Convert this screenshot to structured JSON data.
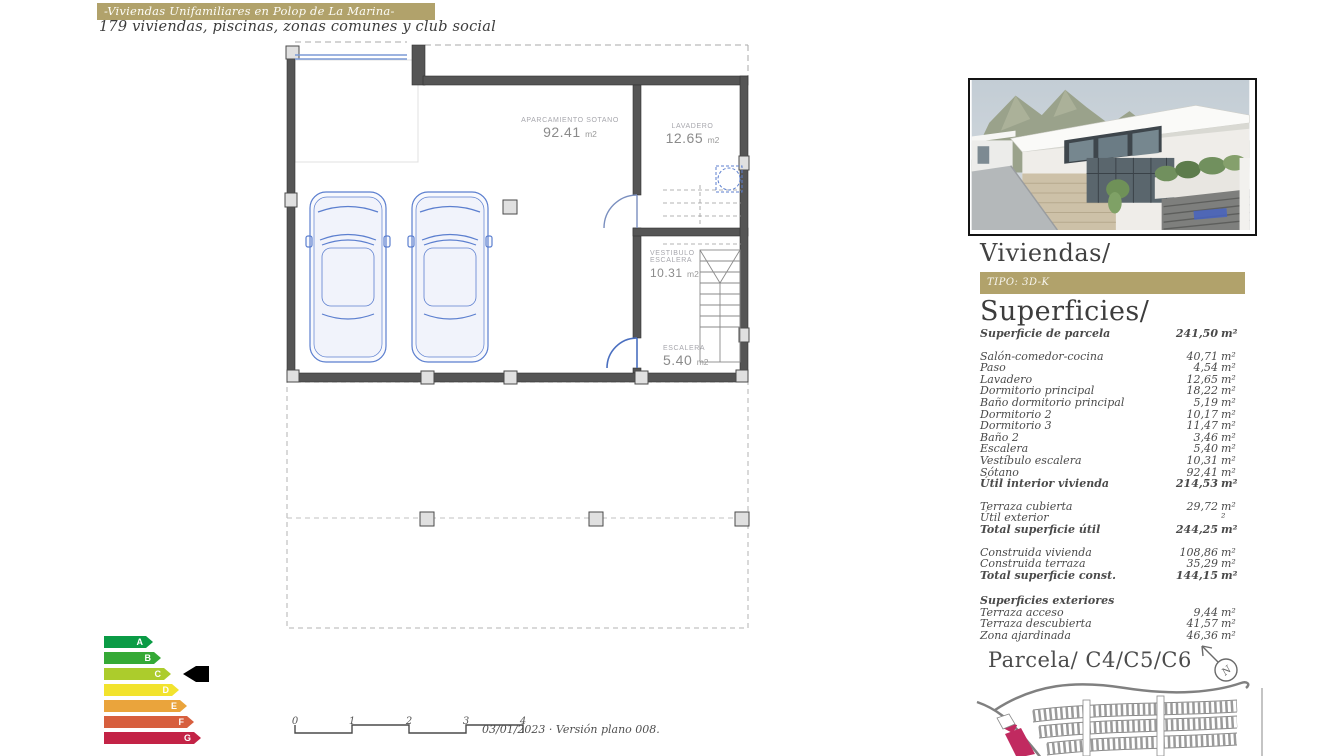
{
  "header": {
    "title": "-Viviendas Unifamiliares en Polop de La Marina-",
    "subtitle": "179 viviendas, piscinas, zonas comunes y club social"
  },
  "plan": {
    "rooms": [
      {
        "name": "APARCAMIENTO SOTANO",
        "value": "92.41",
        "unit": "m2"
      },
      {
        "name": "LAVADERO",
        "value": "12.65",
        "unit": "m2"
      },
      {
        "name": "VESTIBULO ESCALERA",
        "value": "10.31",
        "unit": "m2"
      },
      {
        "name": "ESCALERA",
        "value": "5.40",
        "unit": "m2"
      }
    ]
  },
  "energy": {
    "current": "B",
    "arrow_color": "#000000",
    "grades": [
      {
        "letter": "A",
        "color": "#0a9b45",
        "width": 42
      },
      {
        "letter": "B",
        "color": "#35a936",
        "width": 50
      },
      {
        "letter": "C",
        "color": "#accc2c",
        "width": 60
      },
      {
        "letter": "D",
        "color": "#f2e32e",
        "width": 68
      },
      {
        "letter": "E",
        "color": "#eaa43c",
        "width": 76
      },
      {
        "letter": "F",
        "color": "#d75f3e",
        "width": 83
      },
      {
        "letter": "G",
        "color": "#c32346",
        "width": 90
      }
    ]
  },
  "scale": {
    "ticks": [
      "0",
      "1",
      "2",
      "3",
      "4"
    ]
  },
  "footer_note": "03/01/2023 · Versión plano 008.",
  "sidebar": {
    "viviendas_title": "Viviendas/",
    "tipo": "TIPO: 3D-K",
    "superficies_title": "Superficies/",
    "parcela_title": "Parcela/ C4/C5/C6",
    "gold_color": "#b1a26b",
    "highlight_color": "#c12a60",
    "surface_groups": [
      {
        "rows": [
          {
            "label": "Superficie de parcela",
            "value": "241,50",
            "unit": "m²",
            "bold": true
          }
        ]
      },
      {
        "rows": [
          {
            "label": "Salón-comedor-cocina",
            "value": "40,71",
            "unit": "m²"
          },
          {
            "label": "Paso",
            "value": "4,54",
            "unit": "m²"
          },
          {
            "label": "Lavadero",
            "value": "12,65",
            "unit": "m²"
          },
          {
            "label": "Dormitorio principal",
            "value": "18,22",
            "unit": "m²"
          },
          {
            "label": "Baño dormitorio principal",
            "value": "5,19",
            "unit": "m²"
          },
          {
            "label": "Dormitorio 2",
            "value": "10,17",
            "unit": "m²"
          },
          {
            "label": "Dormitorio 3",
            "value": "11,47",
            "unit": "m²"
          },
          {
            "label": "Baño 2",
            "value": "3,46",
            "unit": "m²"
          },
          {
            "label": "Escalera",
            "value": "5,40",
            "unit": "m²"
          },
          {
            "label": "Vestíbulo escalera",
            "value": "10,31",
            "unit": "m²"
          },
          {
            "label": "Sótano",
            "value": "92,41",
            "unit": "m²"
          },
          {
            "label": "Útil interior vivienda",
            "value": "214,53",
            "unit": "m²",
            "bold": true
          }
        ]
      },
      {
        "rows": [
          {
            "label": "Terraza cubierta",
            "value": "29,72",
            "unit": "m²"
          },
          {
            "label": "Útil exterior",
            "value": "",
            "unit": "²"
          },
          {
            "label": "Total superficie útil",
            "value": "244,25",
            "unit": "m²",
            "bold": true
          }
        ]
      },
      {
        "rows": [
          {
            "label": "Construida vivienda",
            "value": "108,86",
            "unit": "m²"
          },
          {
            "label": "Construida terraza",
            "value": "35,29",
            "unit": "m²"
          },
          {
            "label": "Total superficie const.",
            "value": "144,15",
            "unit": "m²",
            "bold": true
          }
        ]
      },
      {
        "rows": [
          {
            "label": "Superficies exteriores",
            "value": "",
            "unit": "",
            "bold": true
          },
          {
            "label": "Terraza acceso",
            "value": "9,44",
            "unit": "m²"
          },
          {
            "label": "Terraza descubierta",
            "value": "41,57",
            "unit": "m²"
          },
          {
            "label": "Zona ajardinada",
            "value": "46,36",
            "unit": "m²"
          }
        ]
      }
    ]
  }
}
